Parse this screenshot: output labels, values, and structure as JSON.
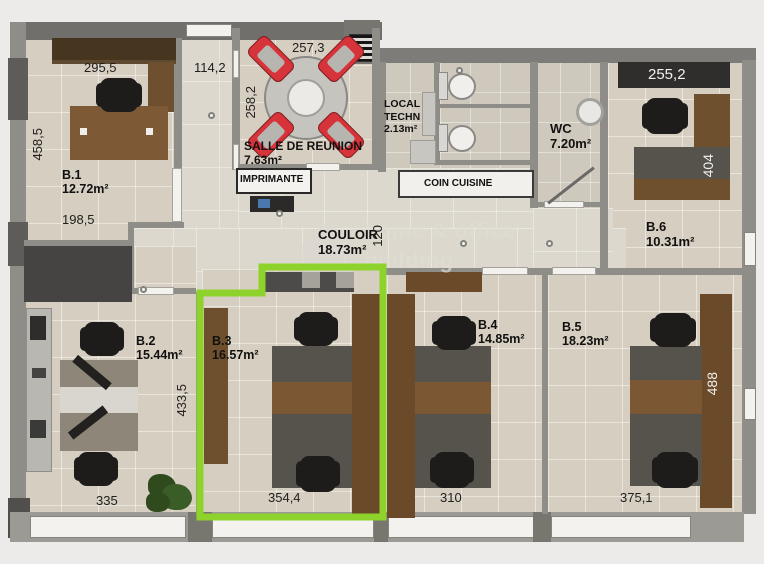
{
  "watermark": {
    "line1": "home & office",
    "line2": "building"
  },
  "rooms": {
    "b1": {
      "name": "B.1",
      "area": "12.72m²"
    },
    "b2": {
      "name": "B.2",
      "area": "15.44m²"
    },
    "b3": {
      "name": "B.3",
      "area": "16.57m²"
    },
    "b4": {
      "name": "B.4",
      "area": "14.85m²"
    },
    "b5": {
      "name": "B.5",
      "area": "18.23m²"
    },
    "b6": {
      "name": "B.6",
      "area": "10.31m²"
    },
    "meeting": {
      "name": "SALLE DE REUNION",
      "area": "7.63m²"
    },
    "local": {
      "line1": "LOCAL",
      "line2": "TECHN",
      "area": "2.13m²"
    },
    "wc": {
      "name": "WC",
      "area": "7.20m²"
    },
    "couloir": {
      "name": "COULOIR",
      "area": "18.73m²"
    },
    "kitchen": {
      "label": "COIN CUISINE"
    },
    "printer": {
      "label": "IMPRIMANTE"
    }
  },
  "dims": {
    "b1_top": "295,5",
    "entry_top": "114,2",
    "meeting_top": "257,3",
    "meeting_left": "258,2",
    "b1_left": "458,5",
    "b1_inner": "198,5",
    "b6_top": "255,2",
    "b6_desk": "404",
    "couloir_w": "120",
    "b2_right": "433,5",
    "b2_bottom": "335",
    "b3_bottom": "354,4",
    "b4_bottom": "310",
    "b5_bottom": "375,1",
    "b5_desk": "488"
  },
  "colors": {
    "highlight": "#8dd32c",
    "wall": "#8e8d88",
    "floor": "#d6cfc1",
    "wood": "#6e4f2e",
    "chair_red": "#d6333a"
  }
}
